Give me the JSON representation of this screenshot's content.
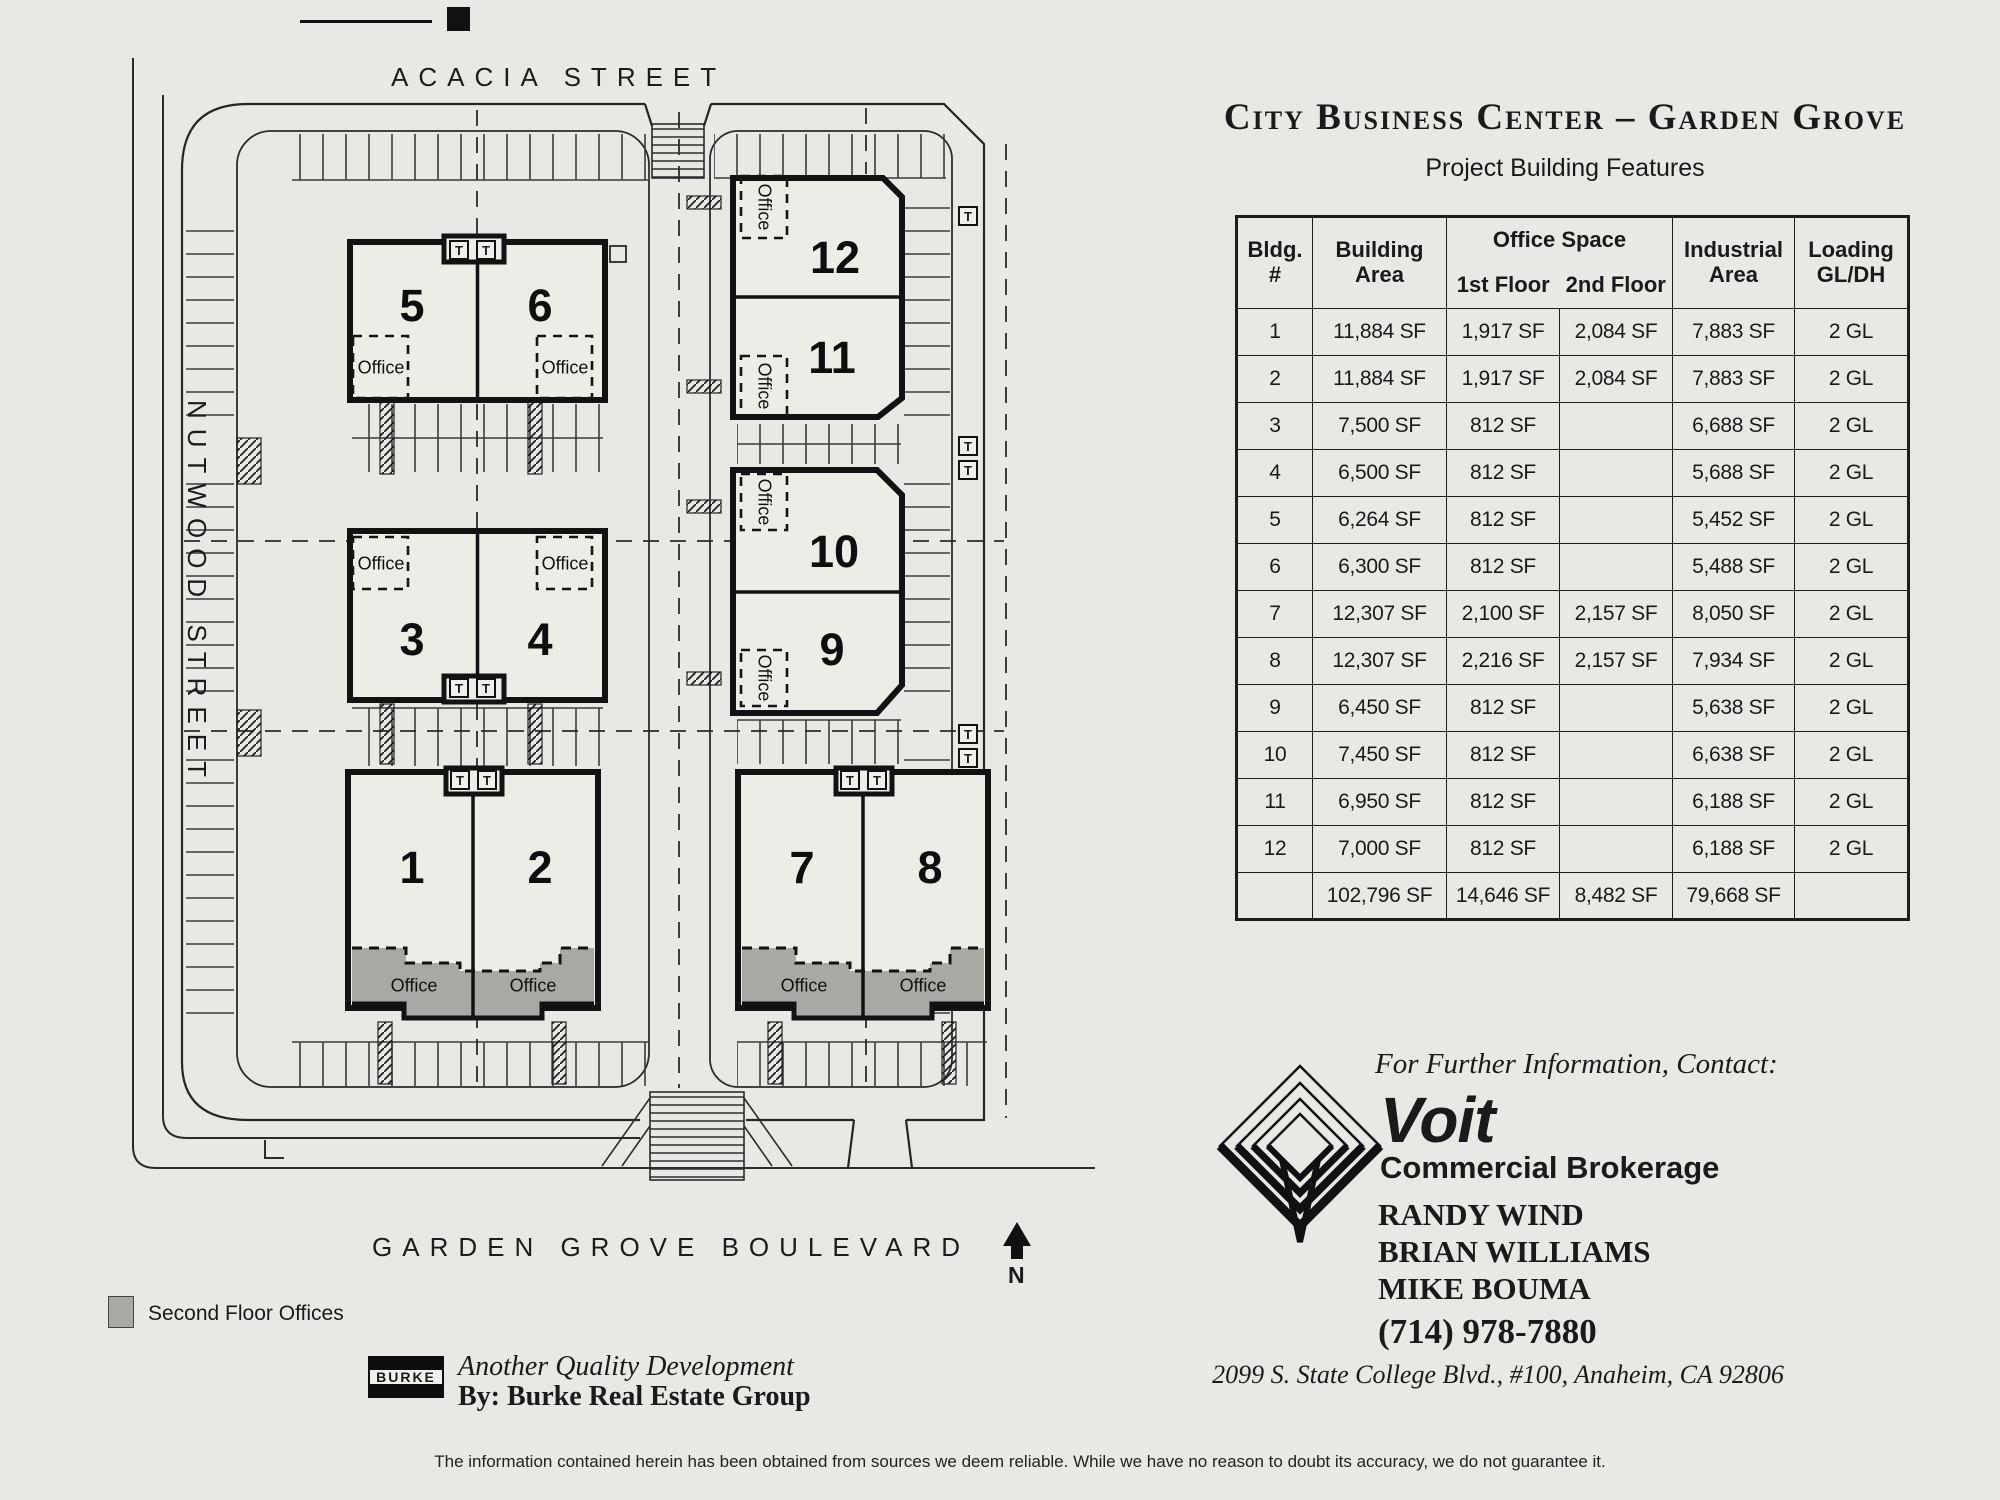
{
  "header": {
    "title": "City Business Center – Garden Grove",
    "subtitle": "Project Building Features"
  },
  "table": {
    "headers": {
      "bldg": "Bldg.\n#",
      "area": "Building\nArea",
      "office": "Office Space",
      "f1": "1st Floor",
      "f2": "2nd Floor",
      "industrial": "Industrial\nArea",
      "loading": "Loading\nGL/DH"
    },
    "rows": [
      {
        "n": "1",
        "area": "11,884 SF",
        "f1": "1,917 SF",
        "f2": "2,084 SF",
        "ind": "7,883 SF",
        "load": "2 GL"
      },
      {
        "n": "2",
        "area": "11,884 SF",
        "f1": "1,917 SF",
        "f2": "2,084 SF",
        "ind": "7,883 SF",
        "load": "2 GL"
      },
      {
        "n": "3",
        "area": "7,500 SF",
        "f1": "812 SF",
        "f2": "",
        "ind": "6,688 SF",
        "load": "2 GL"
      },
      {
        "n": "4",
        "area": "6,500 SF",
        "f1": "812 SF",
        "f2": "",
        "ind": "5,688 SF",
        "load": "2 GL"
      },
      {
        "n": "5",
        "area": "6,264 SF",
        "f1": "812 SF",
        "f2": "",
        "ind": "5,452 SF",
        "load": "2 GL"
      },
      {
        "n": "6",
        "area": "6,300 SF",
        "f1": "812 SF",
        "f2": "",
        "ind": "5,488 SF",
        "load": "2 GL"
      },
      {
        "n": "7",
        "area": "12,307 SF",
        "f1": "2,100 SF",
        "f2": "2,157 SF",
        "ind": "8,050 SF",
        "load": "2 GL"
      },
      {
        "n": "8",
        "area": "12,307 SF",
        "f1": "2,216 SF",
        "f2": "2,157 SF",
        "ind": "7,934 SF",
        "load": "2 GL"
      },
      {
        "n": "9",
        "area": "6,450 SF",
        "f1": "812 SF",
        "f2": "",
        "ind": "5,638 SF",
        "load": "2 GL"
      },
      {
        "n": "10",
        "area": "7,450 SF",
        "f1": "812 SF",
        "f2": "",
        "ind": "6,638 SF",
        "load": "2 GL"
      },
      {
        "n": "11",
        "area": "6,950 SF",
        "f1": "812 SF",
        "f2": "",
        "ind": "6,188 SF",
        "load": "2 GL"
      },
      {
        "n": "12",
        "area": "7,000 SF",
        "f1": "812 SF",
        "f2": "",
        "ind": "6,188 SF",
        "load": "2 GL"
      },
      {
        "n": "",
        "area": "102,796 SF",
        "f1": "14,646 SF",
        "f2": "8,482 SF",
        "ind": "79,668 SF",
        "load": ""
      }
    ]
  },
  "plan": {
    "acacia": "ACACIA STREET",
    "nutwood": "NUTWOOD STREET",
    "garden_grove": "GARDEN GROVE BOULEVARD",
    "north": "N",
    "office_label": "Office",
    "t_label": "T",
    "numbers": [
      "1",
      "2",
      "3",
      "4",
      "5",
      "6",
      "7",
      "8",
      "9",
      "10",
      "11",
      "12"
    ],
    "legend_label": "Second Floor Offices",
    "gray_color": "#a9a8a4"
  },
  "contact": {
    "lead_in": "For Further Information, Contact:",
    "brand": "Voit",
    "brand_sub": "Commercial Brokerage",
    "agents": [
      "RANDY WIND",
      "BRIAN WILLIAMS",
      "MIKE BOUMA"
    ],
    "phone": "(714) 978-7880",
    "address": "2099 S. State College Blvd., #100, Anaheim, CA 92806"
  },
  "developer": {
    "logo": "BURKE",
    "tagline": "Another Quality Development",
    "byline": "By: Burke Real Estate Group"
  },
  "footer": {
    "disclaimer": "The information contained herein has been obtained from sources we deem reliable. While we have no reason to doubt its accuracy, we do not guarantee it."
  }
}
